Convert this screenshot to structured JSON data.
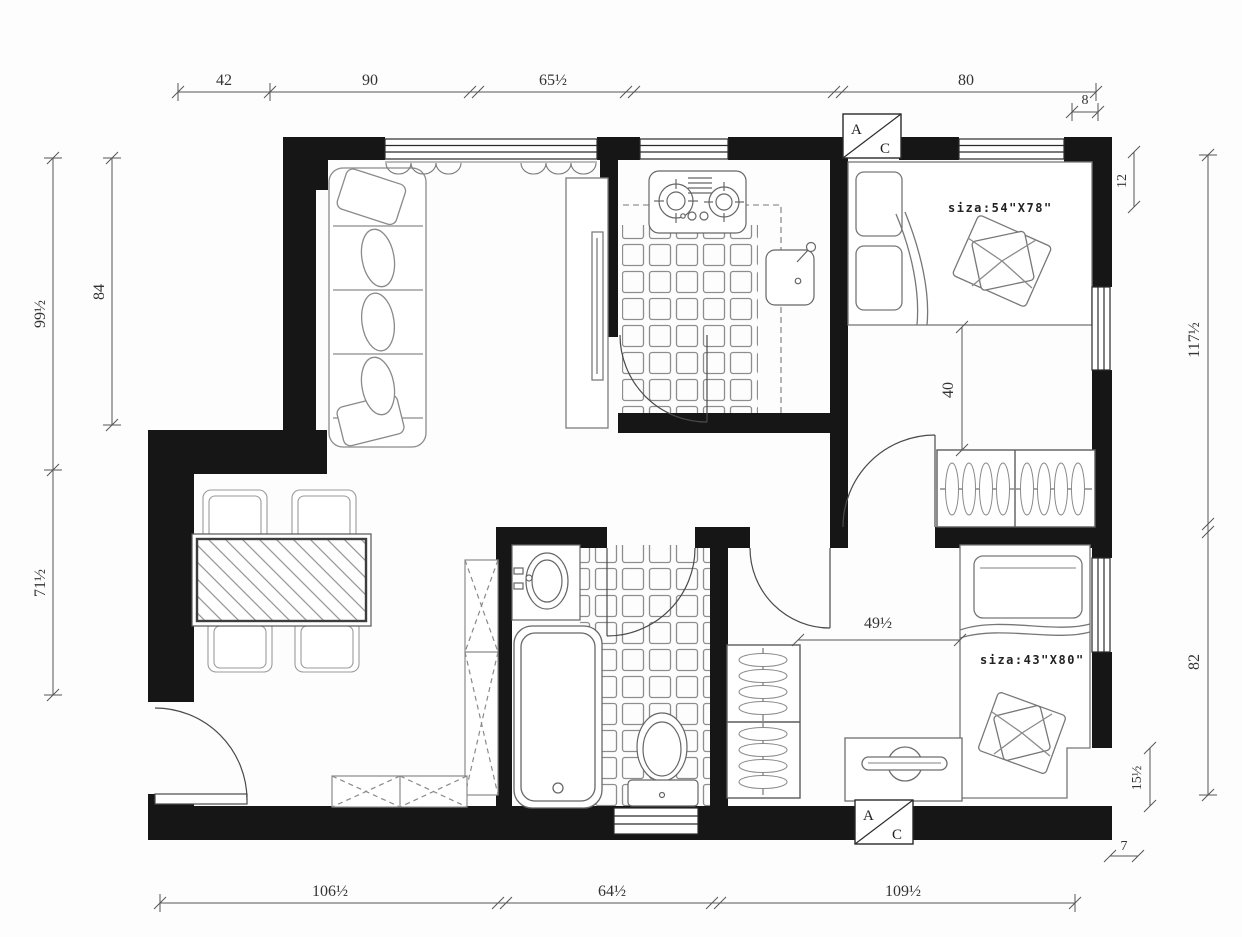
{
  "dimensions": {
    "top": [
      "42",
      "90",
      "65½",
      "80"
    ],
    "top_right_small": "8",
    "right": [
      "12",
      "117½",
      "82",
      "15½",
      "7"
    ],
    "bottom": [
      "106½",
      "64½",
      "109½"
    ],
    "left": [
      "99½",
      "84",
      "71½"
    ],
    "interior": [
      "40",
      "49½"
    ]
  },
  "beds": [
    {
      "size_label": "siza:54\"X78\""
    },
    {
      "size_label": "siza:43\"X80\""
    }
  ],
  "ac_unit": {
    "letter_a": "A",
    "letter_c": "C"
  },
  "colors": {
    "wall": "#161616",
    "line": "#555555",
    "text": "#333333"
  }
}
